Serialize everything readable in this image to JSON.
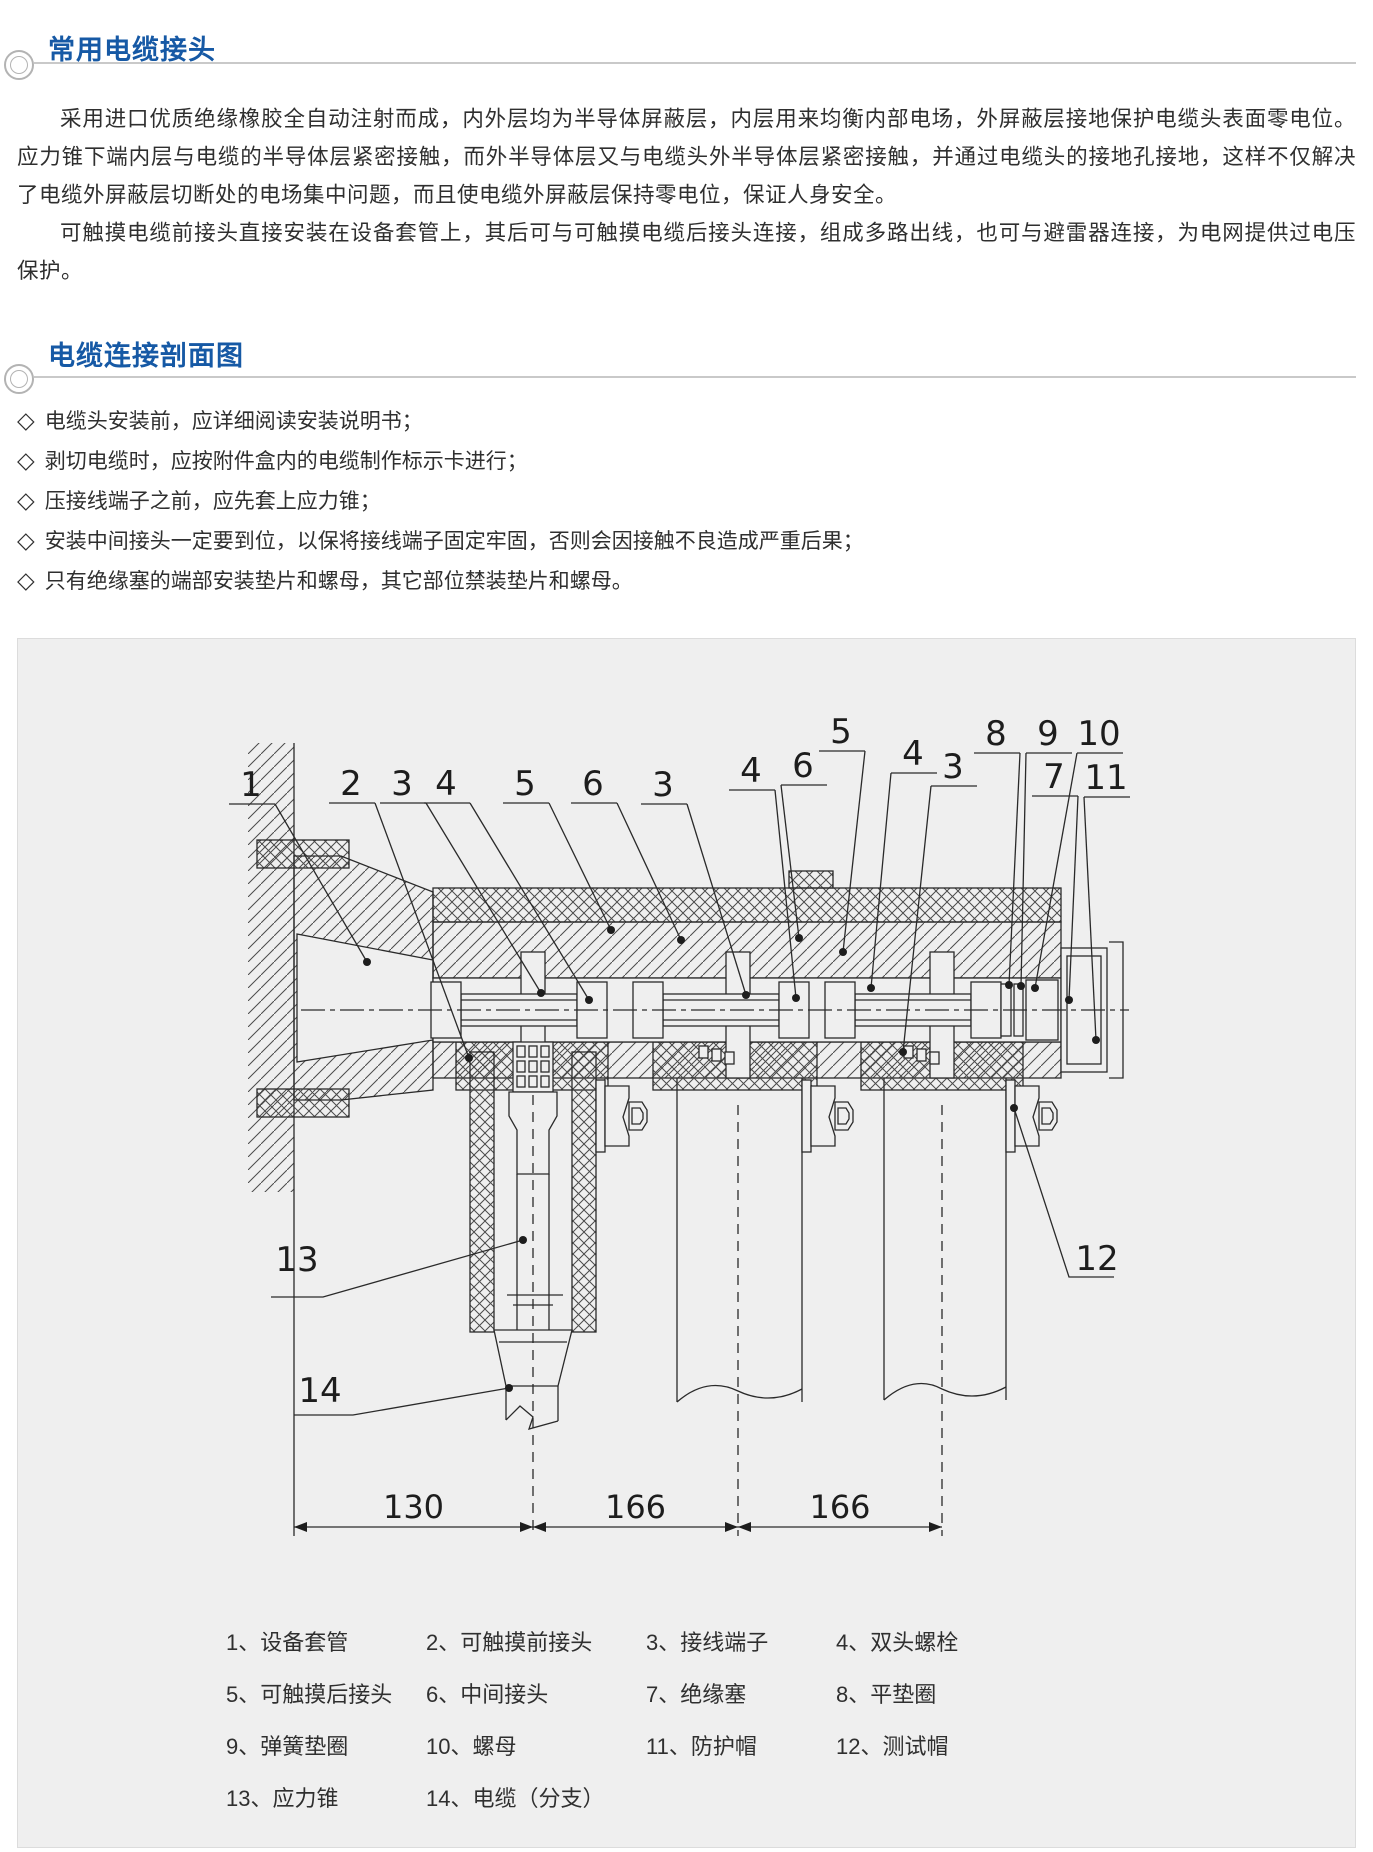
{
  "colors": {
    "accent": "#1659a5",
    "rule": "#c9c9c9",
    "text": "#2f2f2f",
    "line": "#2a2a2a",
    "panel_bg": "#efefef",
    "panel_border": "#dcdcdc"
  },
  "sections": [
    {
      "title": "常用电缆接头"
    },
    {
      "title": "电缆连接剖面图"
    }
  ],
  "paragraphs": [
    "采用进口优质绝缘橡胶全自动注射而成，内外层均为半导体屏蔽层，内层用来均衡内部电场，外屏蔽层接地保护电缆头表面零电位。应力锥下端内层与电缆的半导体层紧密接触，而外半导体层又与电缆头外半导体层紧密接触，并通过电缆头的接地孔接地，这样不仅解决了电缆外屏蔽层切断处的电场集中问题，而且使电缆外屏蔽层保持零电位，保证人身安全。",
    "可触摸电缆前接头直接安装在设备套管上，其后可与可触摸电缆后接头连接，组成多路出线，也可与避雷器连接，为电网提供过电压保护。"
  ],
  "bullet_marker": "◇",
  "bullets": [
    "电缆头安装前，应详细阅读安装说明书；",
    "剥切电缆时，应按附件盒内的电缆制作标示卡进行；",
    "压接线端子之前，应先套上应力锥；",
    "安装中间接头一定要到位，以保将接线端子固定牢固，否则会因接触不良造成严重后果；",
    "只有绝缘塞的端部安装垫片和螺母，其它部位禁装垫片和螺母。"
  ],
  "diagram": {
    "callouts": [
      {
        "n": "1",
        "x": 250,
        "y": 796,
        "tx": 366,
        "ty": 962
      },
      {
        "n": "2",
        "x": 350,
        "y": 795,
        "tx": 468,
        "ty": 1058
      },
      {
        "n": "3",
        "x": 401,
        "y": 795,
        "tx": 540,
        "ty": 993
      },
      {
        "n": "4",
        "x": 445,
        "y": 795,
        "tx": 588,
        "ty": 1000
      },
      {
        "n": "5",
        "x": 524,
        "y": 795,
        "tx": 610,
        "ty": 930
      },
      {
        "n": "6",
        "x": 592,
        "y": 795,
        "tx": 680,
        "ty": 940
      },
      {
        "n": "3",
        "x": 662,
        "y": 796,
        "tx": 745,
        "ty": 995
      },
      {
        "n": "4",
        "x": 750,
        "y": 782,
        "tx": 795,
        "ty": 998
      },
      {
        "n": "6",
        "x": 802,
        "y": 777,
        "tx": 798,
        "ty": 938
      },
      {
        "n": "5",
        "x": 840,
        "y": 743,
        "tx": 842,
        "ty": 952
      },
      {
        "n": "4",
        "x": 912,
        "y": 765,
        "tx": 870,
        "ty": 988
      },
      {
        "n": "3",
        "x": 952,
        "y": 778,
        "tx": 902,
        "ty": 1052
      },
      {
        "n": "8",
        "x": 995,
        "y": 745,
        "tx": 1008,
        "ty": 985
      },
      {
        "n": "9",
        "x": 1047,
        "y": 745,
        "tx": 1020,
        "ty": 986
      },
      {
        "n": "10",
        "x": 1098,
        "y": 745,
        "tx": 1034,
        "ty": 988
      },
      {
        "n": "7",
        "x": 1053,
        "y": 788,
        "tx": 1068,
        "ty": 1000
      },
      {
        "n": "11",
        "x": 1105,
        "y": 789,
        "tx": 1095,
        "ty": 1040
      }
    ],
    "side_callouts": [
      {
        "n": "12",
        "x": 1096,
        "y": 1270,
        "leader": [
          [
            1113,
            1277
          ],
          [
            1068,
            1277
          ],
          [
            1013,
            1108
          ]
        ]
      },
      {
        "n": "13",
        "x": 296,
        "y": 1271,
        "leader": [
          [
            270,
            1297
          ],
          [
            322,
            1297
          ],
          [
            522,
            1240
          ]
        ]
      },
      {
        "n": "14",
        "x": 319,
        "y": 1402,
        "leader": [
          [
            293,
            1415
          ],
          [
            352,
            1415
          ],
          [
            508,
            1388
          ]
        ]
      }
    ],
    "dimensions": {
      "y": 1527,
      "label_y": 1518,
      "boundaries": [
        293,
        532,
        737,
        941
      ],
      "labels": [
        "130",
        "166",
        "166"
      ]
    },
    "legend_rows": [
      [
        "1、设备套管",
        "2、可触摸前接头",
        "3、接线端子",
        "4、双头螺栓"
      ],
      [
        "5、可触摸后接头",
        "6、中间接头",
        "7、绝缘塞",
        "8、平垫圈"
      ],
      [
        "9、弹簧垫圈",
        "10、螺母",
        "11、防护帽",
        "12、测试帽"
      ],
      [
        "13、应力锥",
        "14、电缆（分支）"
      ]
    ]
  }
}
